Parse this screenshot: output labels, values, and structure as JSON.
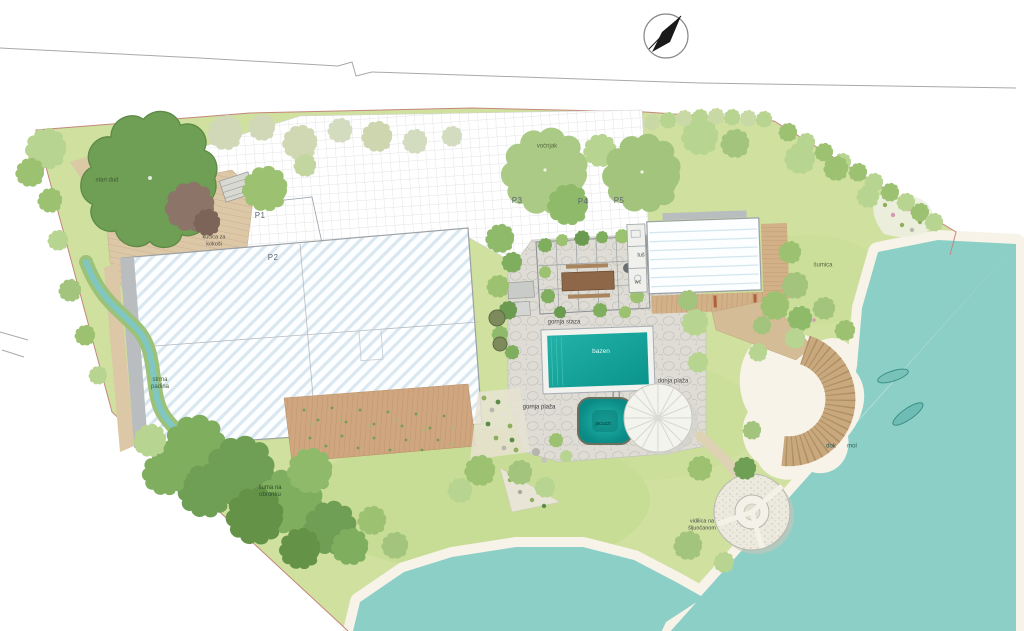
{
  "plan": {
    "labels": {
      "big_tree": "stari dud",
      "chicken_coop": "kućica za\nkokoši",
      "plot1": "P1",
      "plot2": "P2",
      "plot3": "P3",
      "plot4": "P4",
      "plot5": "P5",
      "orchard": "voćnjak",
      "shower": "tuš",
      "wc": "wc",
      "grove": "šumica",
      "upper_path": "gornja staza",
      "pool": "bazen",
      "lower_beach": "donja plaža",
      "upper_beach": "gornja plaža",
      "jacuzzi": "jacuzzi",
      "steep_slope": "strma\npadina",
      "forest_slope": "šuma na\nobronku",
      "lookout": "vidilica na\nšljunčanom",
      "dock": "dok",
      "pier": "mol"
    },
    "colors": {
      "grass": "#cfe09f",
      "water": "#8ccfc7",
      "pool_water": "#0da39a",
      "deck_wood": "#d8c3a0",
      "roof_stripe": "#d9e7f0",
      "boundary_line": "#c4867c",
      "stone_paving": "#dedcd4",
      "beach_sand": "#f7f3e8"
    }
  }
}
